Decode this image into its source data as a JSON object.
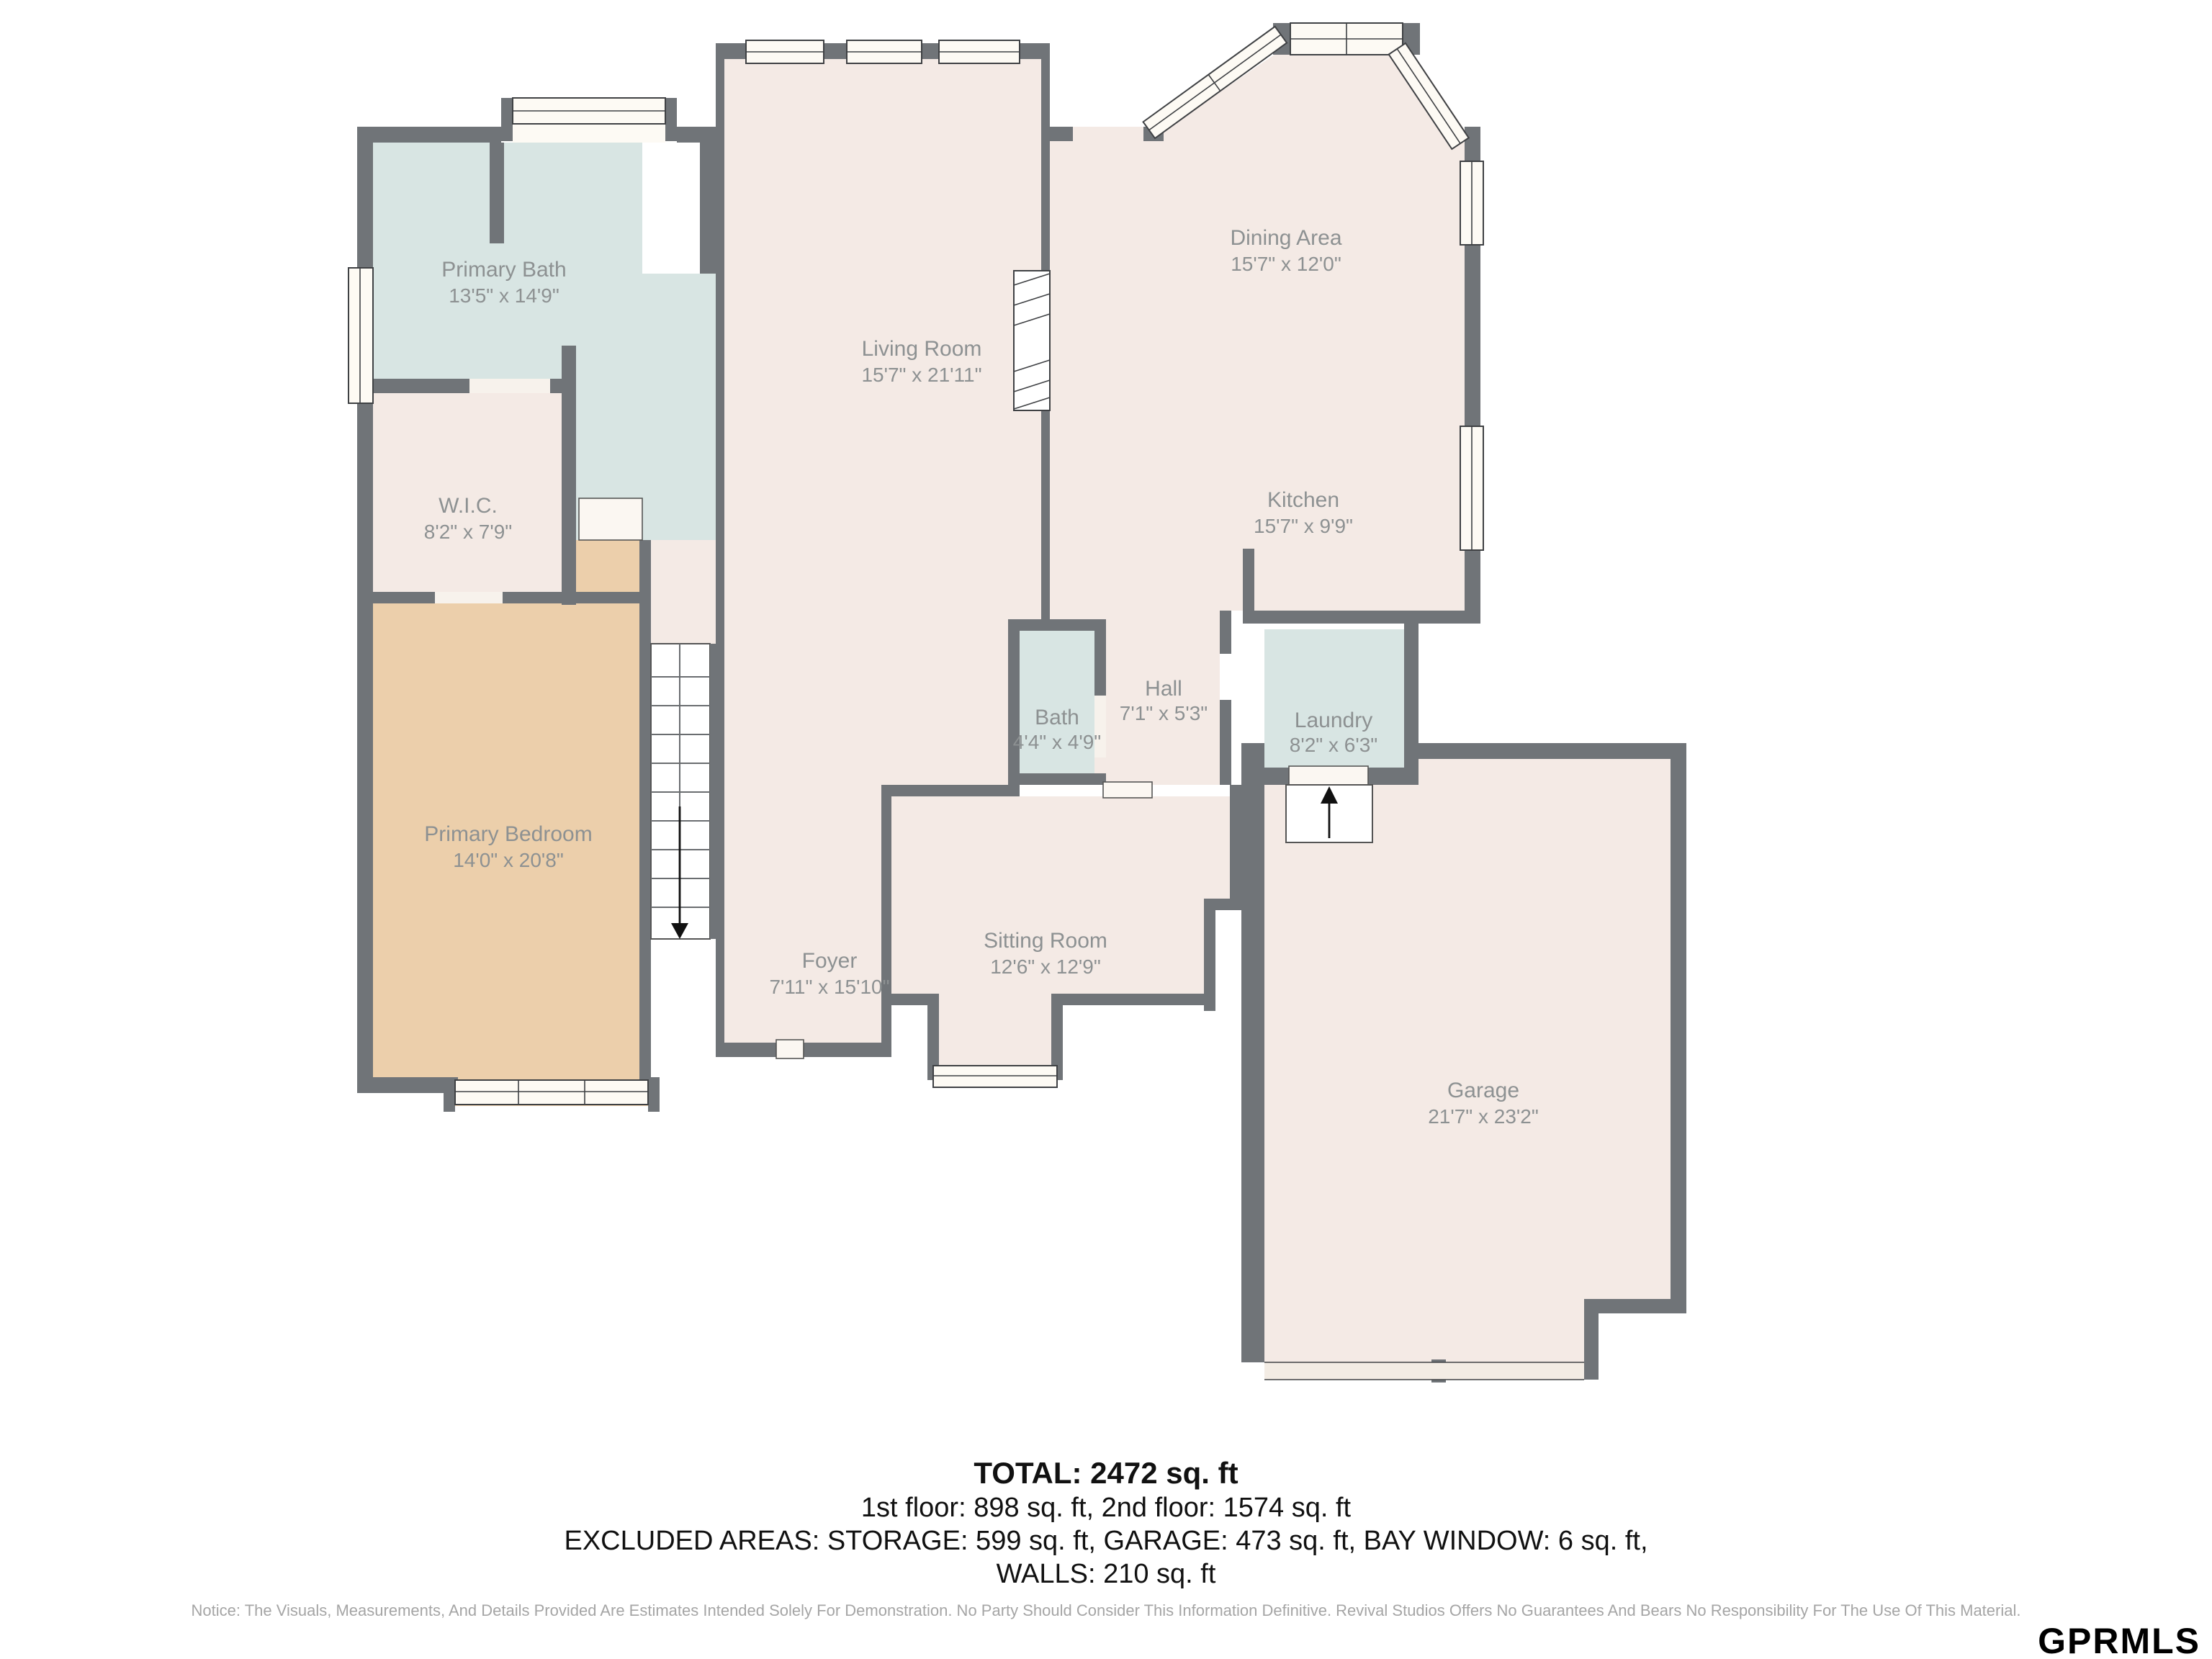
{
  "plan": {
    "rooms": {
      "primary_bath": {
        "name": "Primary Bath",
        "dims": "13'5\" x 14'9\""
      },
      "wic": {
        "name": "W.I.C.",
        "dims": "8'2\" x 7'9\""
      },
      "primary_bedroom": {
        "name": "Primary Bedroom",
        "dims": "14'0\" x 20'8\""
      },
      "living_room": {
        "name": "Living Room",
        "dims": "15'7\" x 21'11\""
      },
      "foyer": {
        "name": "Foyer",
        "dims": "7'11\" x 15'10\""
      },
      "dining_area": {
        "name": "Dining Area",
        "dims": "15'7\" x 12'0\""
      },
      "kitchen": {
        "name": "Kitchen",
        "dims": "15'7\" x 9'9\""
      },
      "hall": {
        "name": "Hall",
        "dims": "7'1\" x 5'3\""
      },
      "bath": {
        "name": "Bath",
        "dims": "4'4\" x 4'9\""
      },
      "laundry": {
        "name": "Laundry",
        "dims": "8'2\" x 6'3\""
      },
      "sitting_room": {
        "name": "Sitting Room",
        "dims": "12'6\" x 12'9\""
      },
      "garage": {
        "name": "Garage",
        "dims": "21'7\" x 23'2\""
      }
    },
    "colors": {
      "wall": "#707478",
      "room_default": "#f4eae5",
      "room_wet": "#d8e5e3",
      "room_bedroom": "#eccfab",
      "label_text": "#8d9192"
    }
  },
  "summary": {
    "total": "TOTAL: 2472 sq. ft",
    "floors": "1st floor: 898 sq. ft, 2nd floor: 1574 sq. ft",
    "excluded": "EXCLUDED AREAS: STORAGE: 599 sq. ft, GARAGE: 473 sq. ft, BAY WINDOW: 6 sq. ft,",
    "walls": "WALLS: 210 sq. ft"
  },
  "notice": "Notice: The Visuals, Measurements, And Details Provided Are Estimates Intended Solely For Demonstration. No Party Should Consider This Information Definitive. Revival Studios Offers No Guarantees And Bears No Responsibility For The Use Of This Material.",
  "logo": "GPRMLS"
}
